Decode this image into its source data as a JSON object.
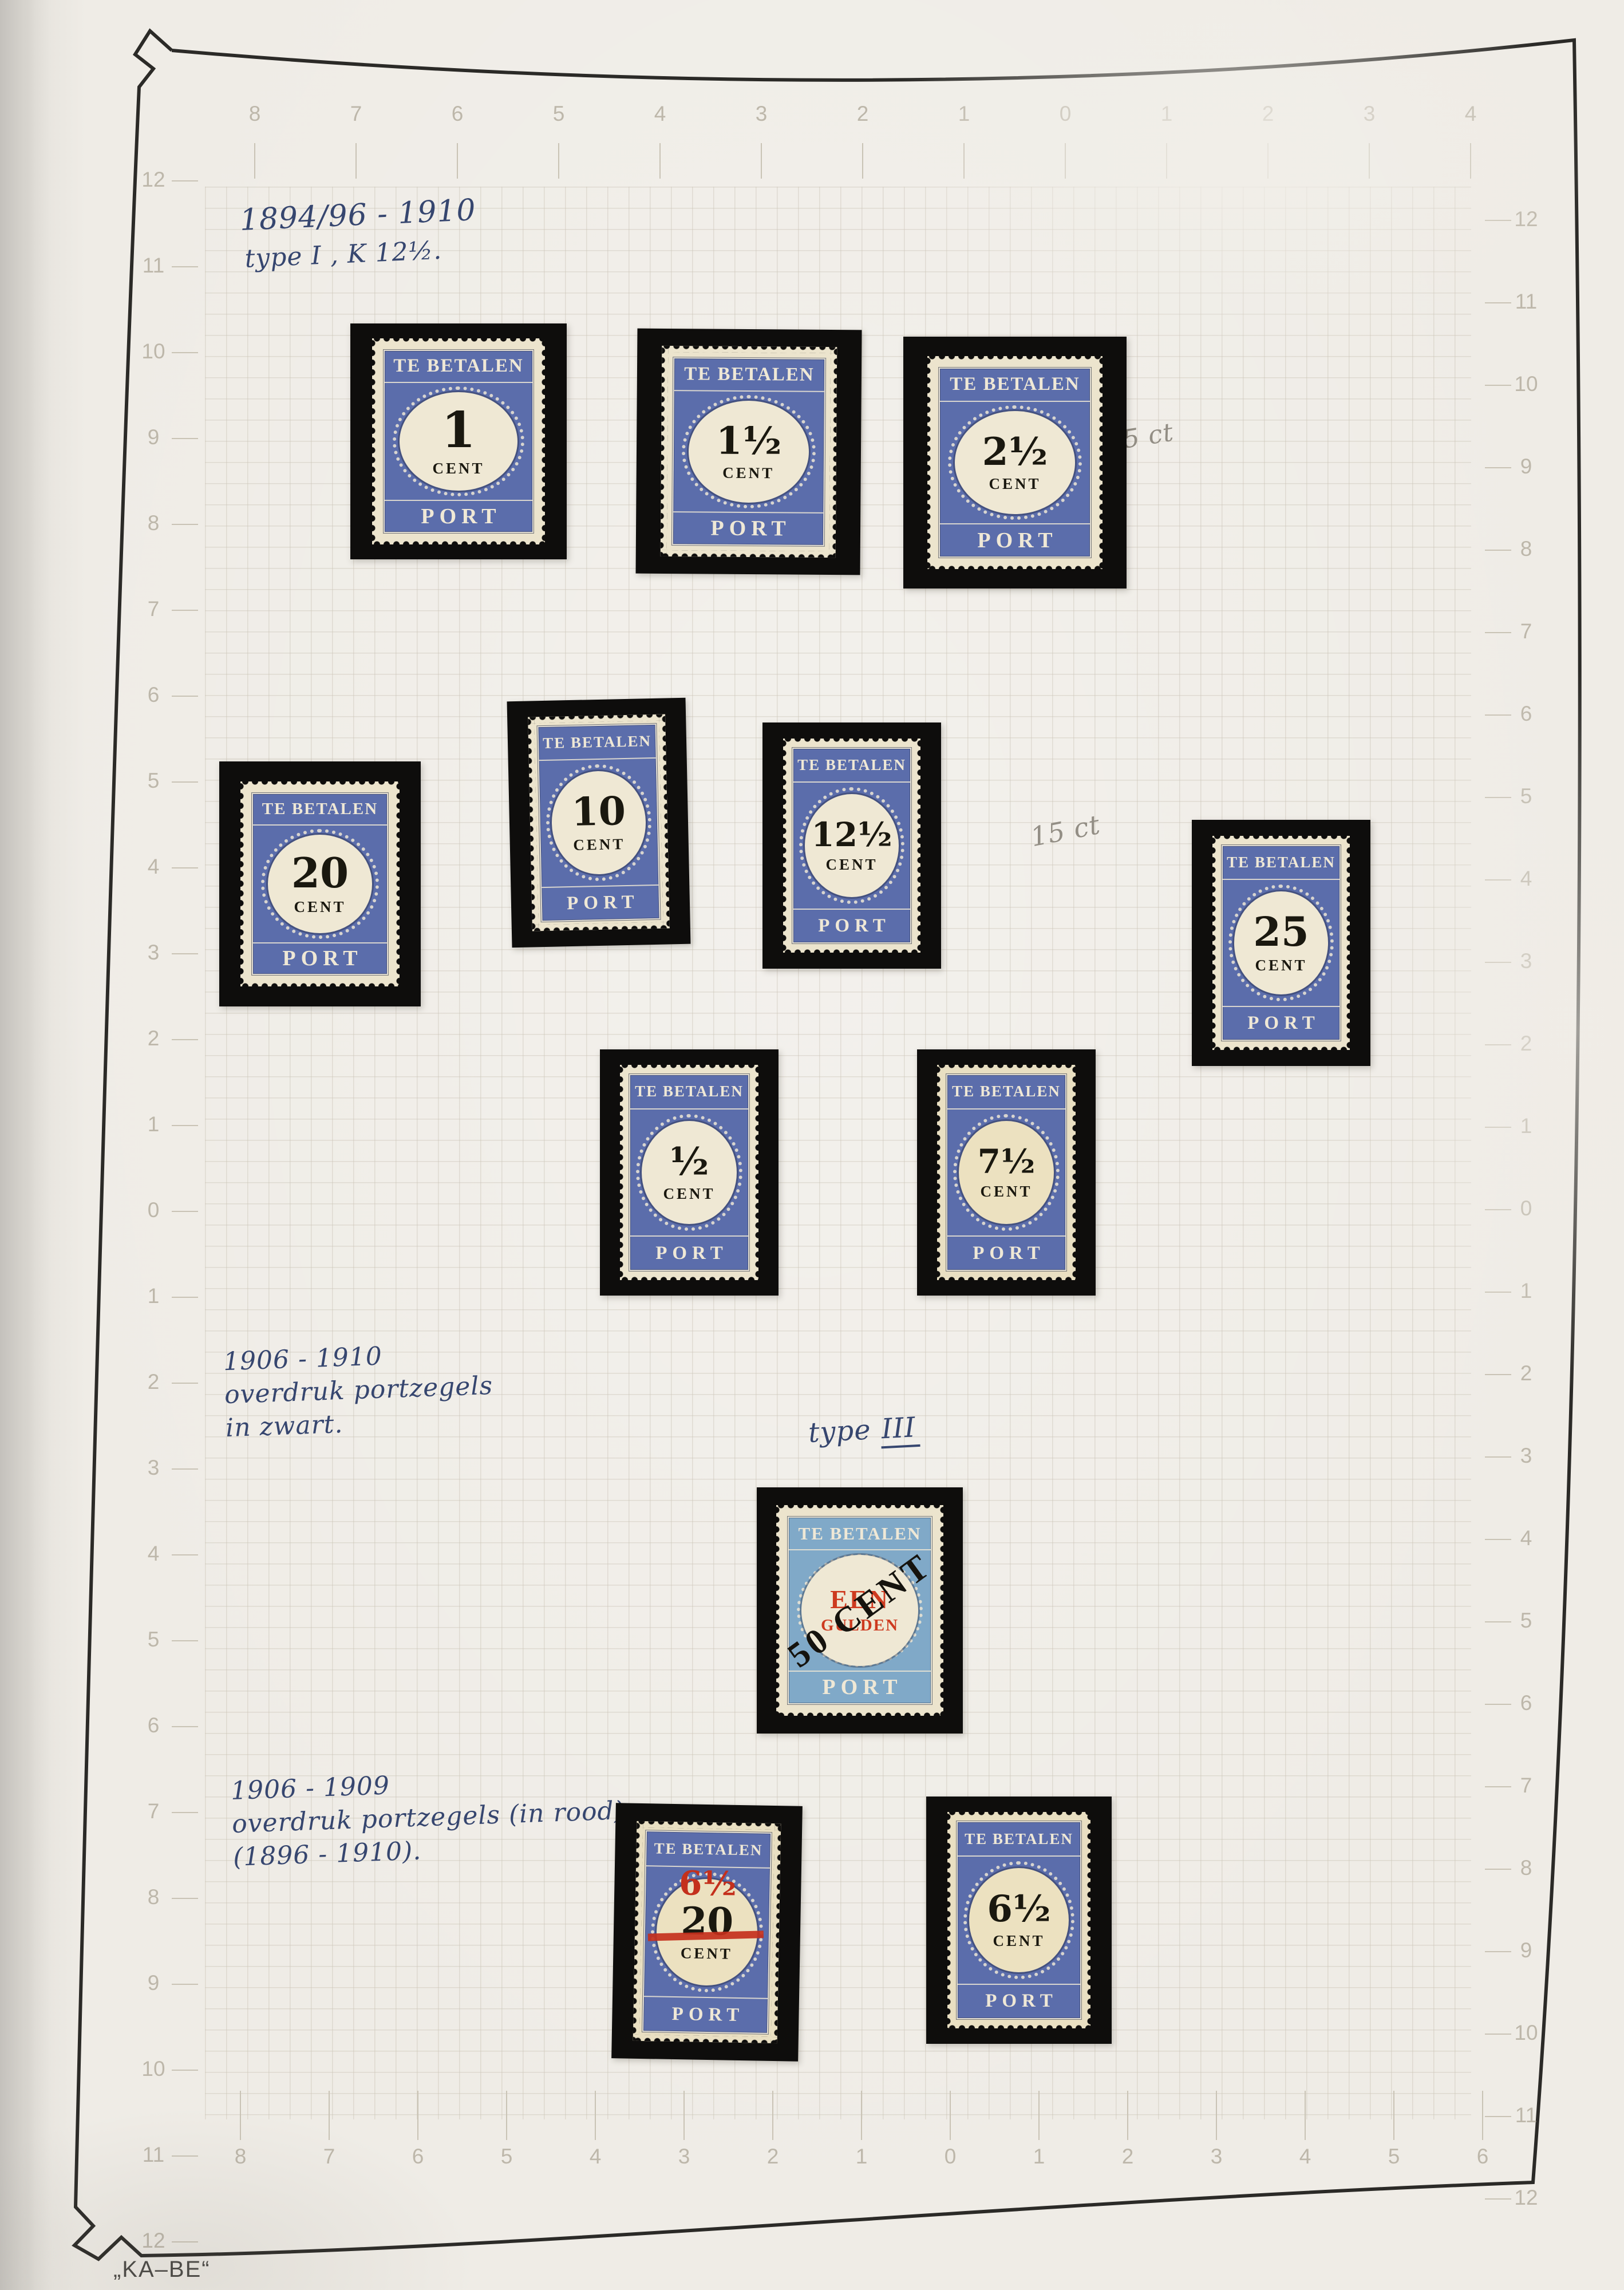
{
  "page": {
    "publisher_mark": "„KA–BE“"
  },
  "colors": {
    "stamp_blue": "#5b6dab",
    "stamp_light_blue": "#80a9c8",
    "overprint_red": "#c4301c",
    "ink_blue": "#36466f",
    "pencil_gray": "#938e85",
    "mount_black": "#0e0d0c",
    "paper": "#efece6"
  },
  "annotations": {
    "period_1": {
      "line1": "1894/96 - 1910",
      "line2": "type I , K 12½."
    },
    "pencil_note_top": "5 ct",
    "pencil_note_mid": "15 ct",
    "period_2": {
      "line1": "1906 - 1910",
      "line2": "overdruk portzegels",
      "line3": "in zwart."
    },
    "type_note": {
      "prefix": "type ",
      "numeral": "III"
    },
    "period_3": {
      "line1": "1906 - 1909",
      "line2": "overdruk portzegels (in rood)",
      "line3": "(1896 - 1910)."
    }
  },
  "rulers": {
    "top": [
      "8",
      "7",
      "6",
      "5",
      "4",
      "3",
      "2",
      "1",
      "0",
      "1",
      "2",
      "3",
      "4"
    ],
    "bottom": [
      "8",
      "7",
      "6",
      "5",
      "4",
      "3",
      "2",
      "1",
      "0",
      "1",
      "2",
      "3",
      "4",
      "5",
      "6"
    ],
    "left": [
      "12",
      "11",
      "10",
      "9",
      "8",
      "7",
      "6",
      "5",
      "4",
      "3",
      "2",
      "1",
      "0",
      "1",
      "2",
      "3",
      "4",
      "5",
      "6",
      "7",
      "8",
      "9",
      "10",
      "11",
      "12"
    ],
    "right": [
      "12",
      "11",
      "10",
      "9",
      "8",
      "7",
      "6",
      "5",
      "4",
      "3",
      "2",
      "1",
      "0",
      "1",
      "2",
      "3",
      "4",
      "5",
      "6",
      "7",
      "8",
      "9",
      "10",
      "11",
      "12"
    ]
  },
  "stamps": [
    {
      "header": "TE BETALEN",
      "value": "1",
      "unit": "CENT",
      "footer": "PORT"
    },
    {
      "header": "TE BETALEN",
      "value": "1½",
      "unit": "CENT",
      "footer": "PORT"
    },
    {
      "header": "TE BETALEN",
      "value": "2½",
      "unit": "CENT",
      "footer": "PORT"
    },
    {
      "header": "TE BETALEN",
      "value": "20",
      "unit": "CENT",
      "footer": "PORT"
    },
    {
      "header": "TE BETALEN",
      "value": "10",
      "unit": "CENT",
      "footer": "PORT"
    },
    {
      "header": "TE BETALEN",
      "value": "12½",
      "unit": "CENT",
      "footer": "PORT"
    },
    {
      "header": "TE BETALEN",
      "value": "25",
      "unit": "CENT",
      "footer": "PORT"
    },
    {
      "header": "TE BETALEN",
      "value": "½",
      "unit": "CENT",
      "footer": "PORT"
    },
    {
      "header": "TE BETALEN",
      "value": "7½",
      "unit": "CENT",
      "footer": "PORT"
    },
    {
      "header": "TE BETALEN",
      "value_line1": "EEN",
      "value_line2": "GULDEN",
      "overprint": "50 CENT",
      "footer": "PORT"
    },
    {
      "header": "TE BETALEN",
      "value": "20",
      "unit": "CENT",
      "footer": "PORT",
      "overprint": "6½"
    },
    {
      "header": "TE BETALEN",
      "value": "6½",
      "unit": "CENT",
      "footer": "PORT"
    }
  ]
}
